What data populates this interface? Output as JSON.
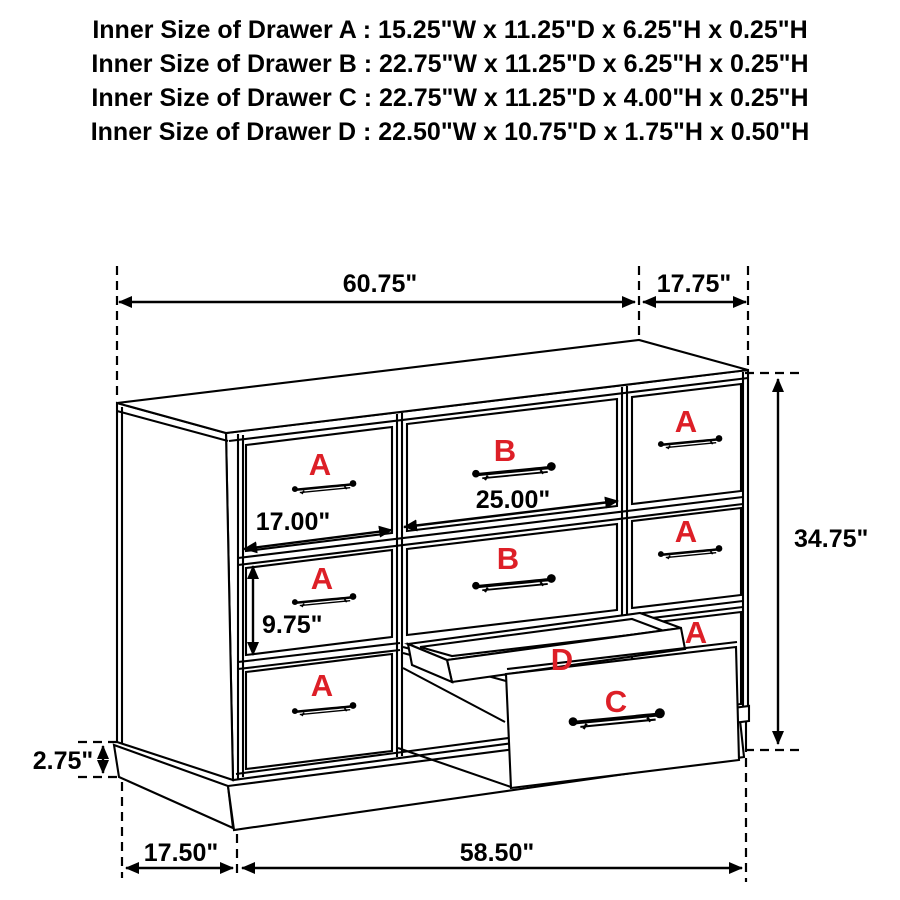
{
  "header": {
    "lines": [
      "Inner Size of Drawer A : 15.25\"W x 11.25\"D x 6.25\"H x 0.25\"H",
      "Inner Size of Drawer B : 22.75\"W x 11.25\"D x 6.25\"H x 0.25\"H",
      "Inner Size of Drawer C : 22.75\"W x 11.25\"D x 4.00\"H x 0.25\"H",
      "Inner Size of Drawer  D : 22.50\"W x 10.75\"D x 1.75\"H x 0.50\"H"
    ]
  },
  "dimensions": {
    "top_width": "60.75\"",
    "top_depth": "17.75\"",
    "overall_height": "34.75\"",
    "a_drawer_width": "17.00\"",
    "b_drawer_width": "25.00\"",
    "a_drawer_height": "9.75\"",
    "base_height": "2.75\"",
    "base_side_depth": "17.50\"",
    "base_front_width": "58.50\""
  },
  "drawers": {
    "left_column": [
      "A",
      "A",
      "A"
    ],
    "middle_column": [
      "B",
      "B"
    ],
    "right_column": [
      "A",
      "A",
      "A"
    ],
    "pullouts": {
      "tray": "D",
      "drawer": "C"
    }
  },
  "colors": {
    "line": "#000000",
    "drawer_label": "#dd1f27",
    "background": "#ffffff"
  }
}
